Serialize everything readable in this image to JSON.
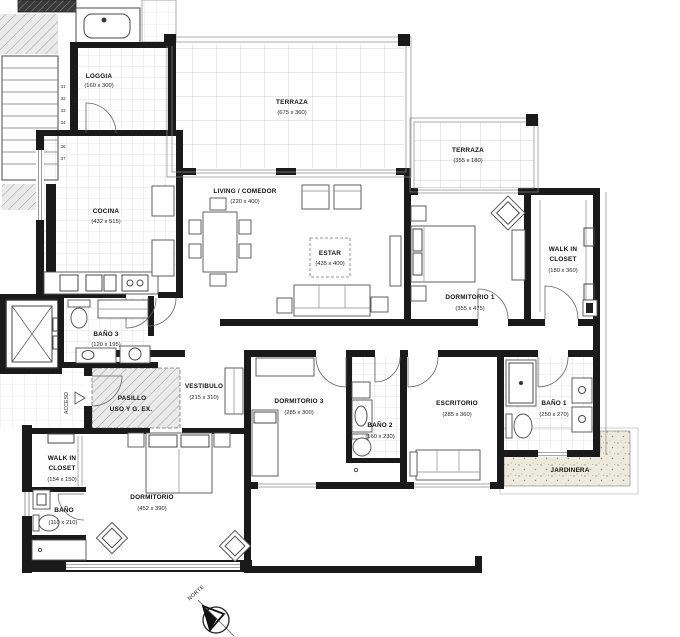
{
  "rooms": {
    "loggia": {
      "name": "LOGGIA",
      "dims": "(160 x 300)"
    },
    "terraza_main": {
      "name": "TERRAZA",
      "dims": "(675 x 360)"
    },
    "terraza_small": {
      "name": "TERRAZA",
      "dims": "(355 x 180)"
    },
    "cocina": {
      "name": "COCINA",
      "dims": "(432 x 515)"
    },
    "living_comedor": {
      "name": "LIVING / COMEDOR",
      "dims": "(220 x 400)"
    },
    "estar": {
      "name": "ESTAR",
      "dims": "(435 x 400)"
    },
    "dormitorio1": {
      "name": "DORMITORIO 1",
      "dims": "(355 x 475)"
    },
    "walk_in_closet1": {
      "name_line1": "WALK IN",
      "name_line2": "CLOSET",
      "dims": "(180 x 360)"
    },
    "bano3": {
      "name": "BAÑO 3",
      "dims": "(120 x 195)"
    },
    "pasillo": {
      "name_line1": "PASILLO",
      "name_line2": "USO Y G. EX."
    },
    "vestibulo": {
      "name": "VESTIBULO",
      "dims": "(215 x 310)"
    },
    "dormitorio3": {
      "name": "DORMITORIO 3",
      "dims": "(285 x 300)"
    },
    "bano2": {
      "name": "BAÑO 2",
      "dims": "(160 x 230)"
    },
    "escritorio": {
      "name": "ESCRITORIO",
      "dims": "(285 x 360)"
    },
    "bano1": {
      "name": "BAÑO 1",
      "dims": "(250 x 270)"
    },
    "jardinera": {
      "name": "JARDINERA"
    },
    "walk_in_closet2": {
      "name_line1": "WALK IN",
      "name_line2": "CLOSET",
      "dims": "(154 x 150)"
    },
    "dormitorio_ppal": {
      "name": "DORMITORIO",
      "dims": "(452 x 390)"
    },
    "bano_ppal": {
      "name": "BAÑO",
      "dims": "(110 x 210)"
    }
  },
  "annotations": {
    "acceso": "ACCESO",
    "norte": "NORTE",
    "stair_steps": [
      "31",
      "32",
      "33",
      "34",
      "35",
      "36",
      "37"
    ]
  },
  "colors": {
    "wall": "#1a1a1a",
    "line": "#555555",
    "tile": "#c4c4c4",
    "jardinera_fill": "#eceadb",
    "paper": "#ffffff"
  }
}
